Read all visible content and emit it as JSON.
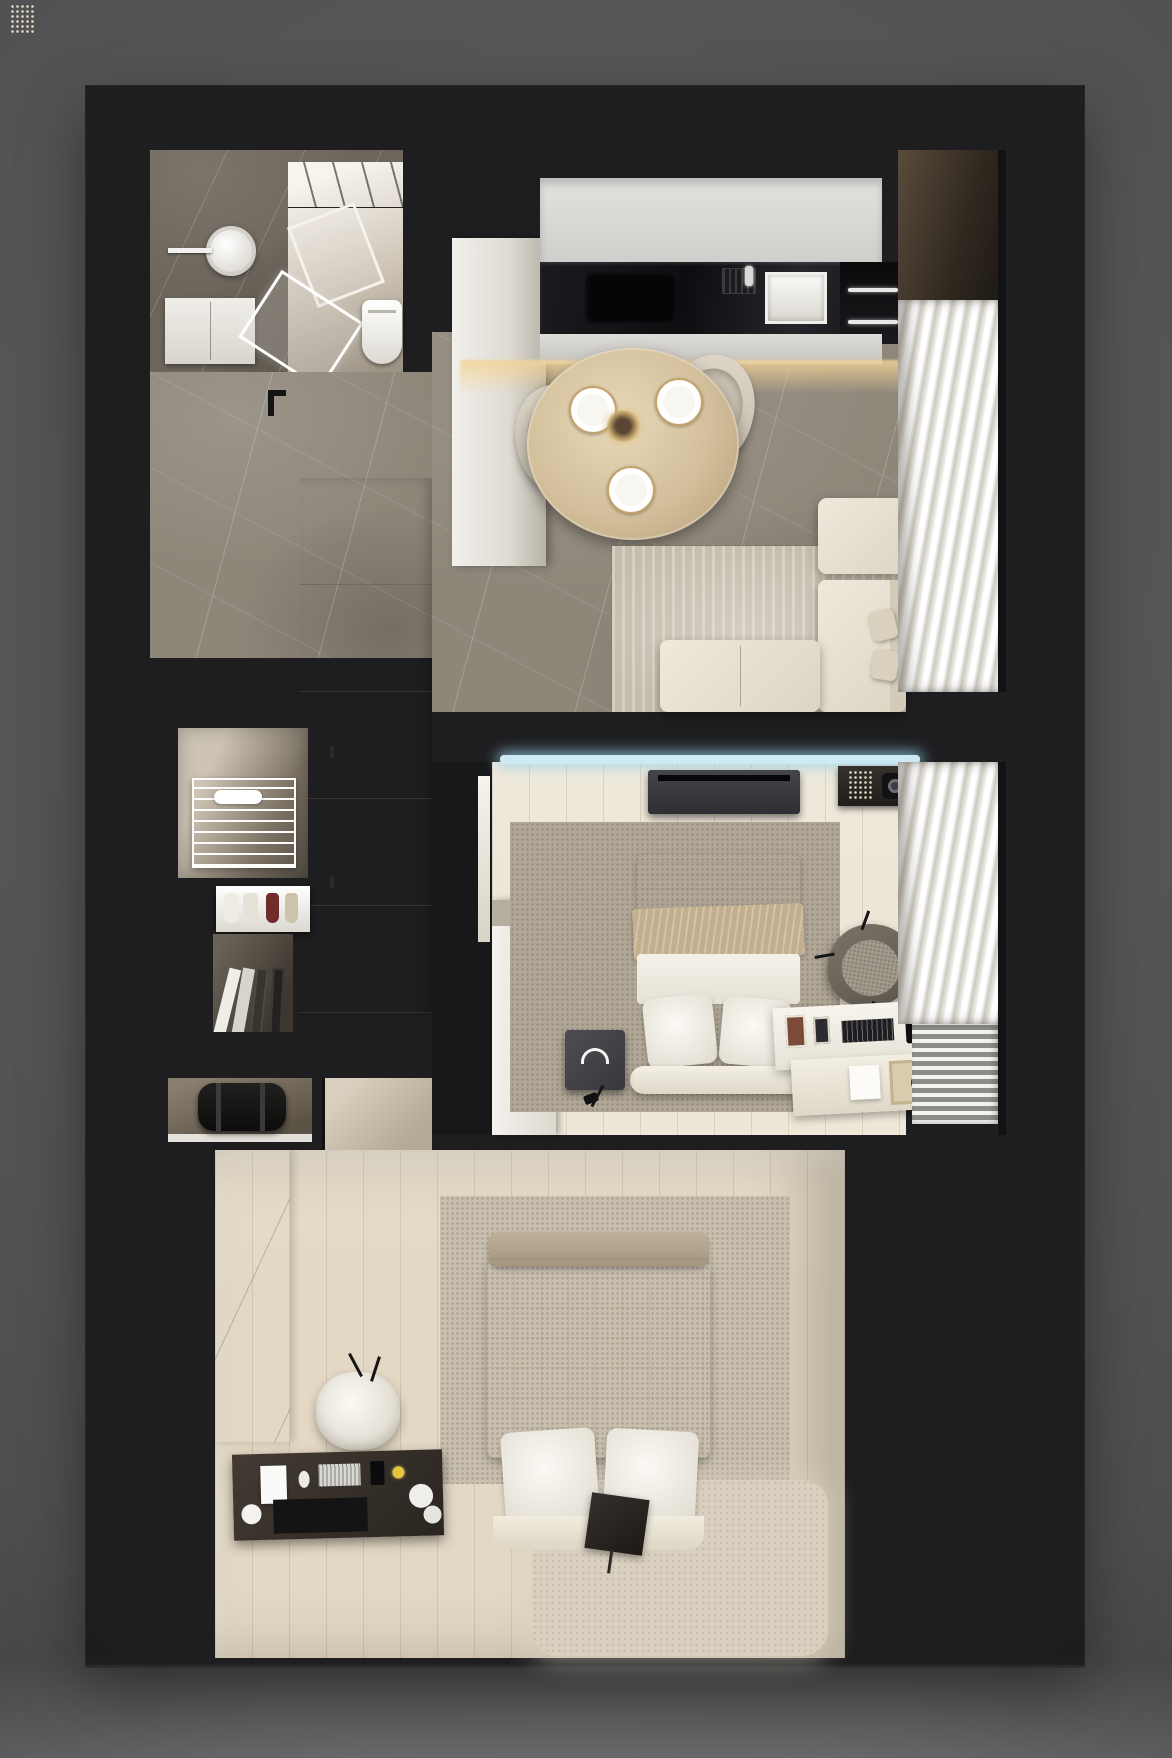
{
  "scene": {
    "title": "Top-down 3D render — small apartment floor plan",
    "render_style": "photorealistic overhead cutaway on black base over gray backdrop",
    "visible_text": "none"
  },
  "colors": {
    "bg": "#525254",
    "base": "#1e1e20",
    "marble": "#8e8679",
    "marbledark": "#6d655b",
    "wood1": "#eee7d8",
    "wood2": "#e3d8c4",
    "wood3": "#d3c6b2",
    "cream": "#eae4d7",
    "rugliving": "#c5bcab",
    "rug1": "#b0a797",
    "rug2": "#d9d0bf",
    "counter": "#101014",
    "cabinet": "#d8d7d4",
    "ledwarm": "#f4d496",
    "ledcool": "#cdeaf4",
    "throw": "#c3af8e",
    "tablewood": "#d3bf9b",
    "curtain": "#f6f4ef"
  },
  "rooms": {
    "bathroom": {
      "label": "Bathroom",
      "items": [
        "walk-in shower with glass partition",
        "round washbasin",
        "towel bar",
        "white vanity cabinet",
        "toilet",
        "dark marble walls"
      ]
    },
    "hallway": {
      "label": "Entry hallway",
      "items": [
        "gray marble floor",
        "door swing mark",
        "built-in white wardrobe with handles",
        "entry bench",
        "vestibule floor"
      ]
    },
    "closet": {
      "label": "Storage closet",
      "items": [
        "white wire shelving rack",
        "shoe shelf with sneakers and heels",
        "leaning files and frames",
        "shelf with black duffel bag"
      ]
    },
    "kitchen": {
      "label": "Kitchen",
      "items": [
        "tall fridge column",
        "upper cabinets with diagonal seams",
        "black countertop",
        "induction cooktop",
        "dish rack",
        "sink with faucet",
        "two built-in ovens",
        "lower cabinets",
        "warm LED toe-kick glow"
      ]
    },
    "dining": {
      "label": "Dining area",
      "items": [
        "round oak table",
        "three place settings with gold cutlery",
        "centerpiece",
        "two upholstered chairs"
      ]
    },
    "living": {
      "label": "Living area",
      "items": [
        "L-shaped cream sofa",
        "ottoman",
        "two sofa pillows",
        "area rug",
        "sheer wavy curtains",
        "dark window sill"
      ]
    },
    "bedroom1": {
      "label": "Bedroom 1",
      "items": [
        "LED-lit media wall",
        "TV console",
        "decor console with plant and projector",
        "white wardrobe",
        "speckled rug",
        "double bed with tan throw",
        "two pillows",
        "foot bench",
        "nightstand cube with headphones",
        "armchair",
        "white desk with frames, keyboard and dock",
        "shelf with safe",
        "small floor lamp",
        "curtains",
        "radiator fins"
      ]
    },
    "bedroom2": {
      "label": "Bedroom 2 (master)",
      "items": [
        "white paneled wall",
        "plank wood floor",
        "two rugs",
        "bed with quilted duvet",
        "upholstered footboard",
        "two pillows",
        "dark tray with tassel",
        "white pouf side table",
        "dark desk with laptop, tablet, keyboard, mouse, phone and duck figurine",
        "plant stand",
        "white nightstand with notepad",
        "black floor lamp",
        "two glowing glass display cases",
        "curtains",
        "radiator slats"
      ]
    },
    "balcony": {
      "label": "Balcony / loggia",
      "items": [
        "vertical plank wood floor",
        "tall window with two glowing panes",
        "dark perimeter wall"
      ]
    }
  }
}
